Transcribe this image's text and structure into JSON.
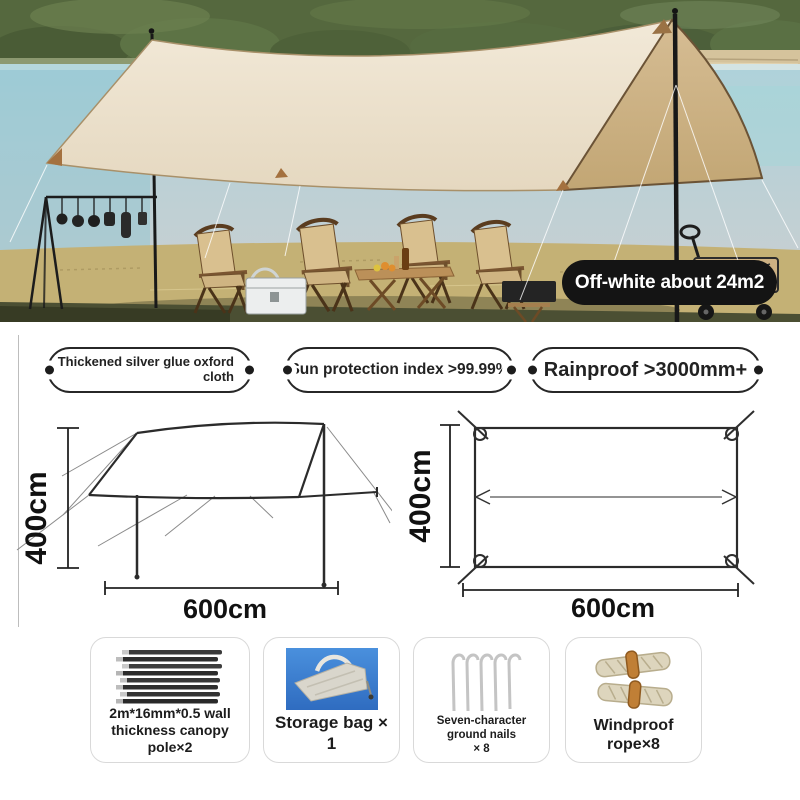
{
  "photo": {
    "badge_label": "Off-white about 24m2",
    "scene": "camping lakeside with beige canopy tarp, chairs, table, hanging rack, wagon"
  },
  "features": [
    {
      "text": "Thickened silver glue oxford\ncloth"
    },
    {
      "text": "Sun protection index >99.99%"
    },
    {
      "text": "Rainproof >3000mm+"
    }
  ],
  "diagrams": {
    "side_view": {
      "height_label": "400cm",
      "width_label": "600cm"
    },
    "top_view": {
      "height_label": "400cm",
      "width_label": "600cm"
    }
  },
  "components": [
    {
      "icon": "canopy-poles",
      "label": "2m*16mm*0.5 wall\nthickness canopy\npole×2"
    },
    {
      "icon": "storage-bag",
      "label": "Storage bag × 1"
    },
    {
      "icon": "ground-nails",
      "label": "Seven-character ground nails\n× 8"
    },
    {
      "icon": "windproof-rope",
      "label": "Windproof rope×8"
    }
  ],
  "colors": {
    "badge_bg": "#141414",
    "tarp": "#eadfc9",
    "tarp_side": "#c8ac7e",
    "water": "#bccdd2",
    "grass": "#c4b175",
    "card_border": "#d9d9d9",
    "bag_blue": "#3f87d8"
  }
}
